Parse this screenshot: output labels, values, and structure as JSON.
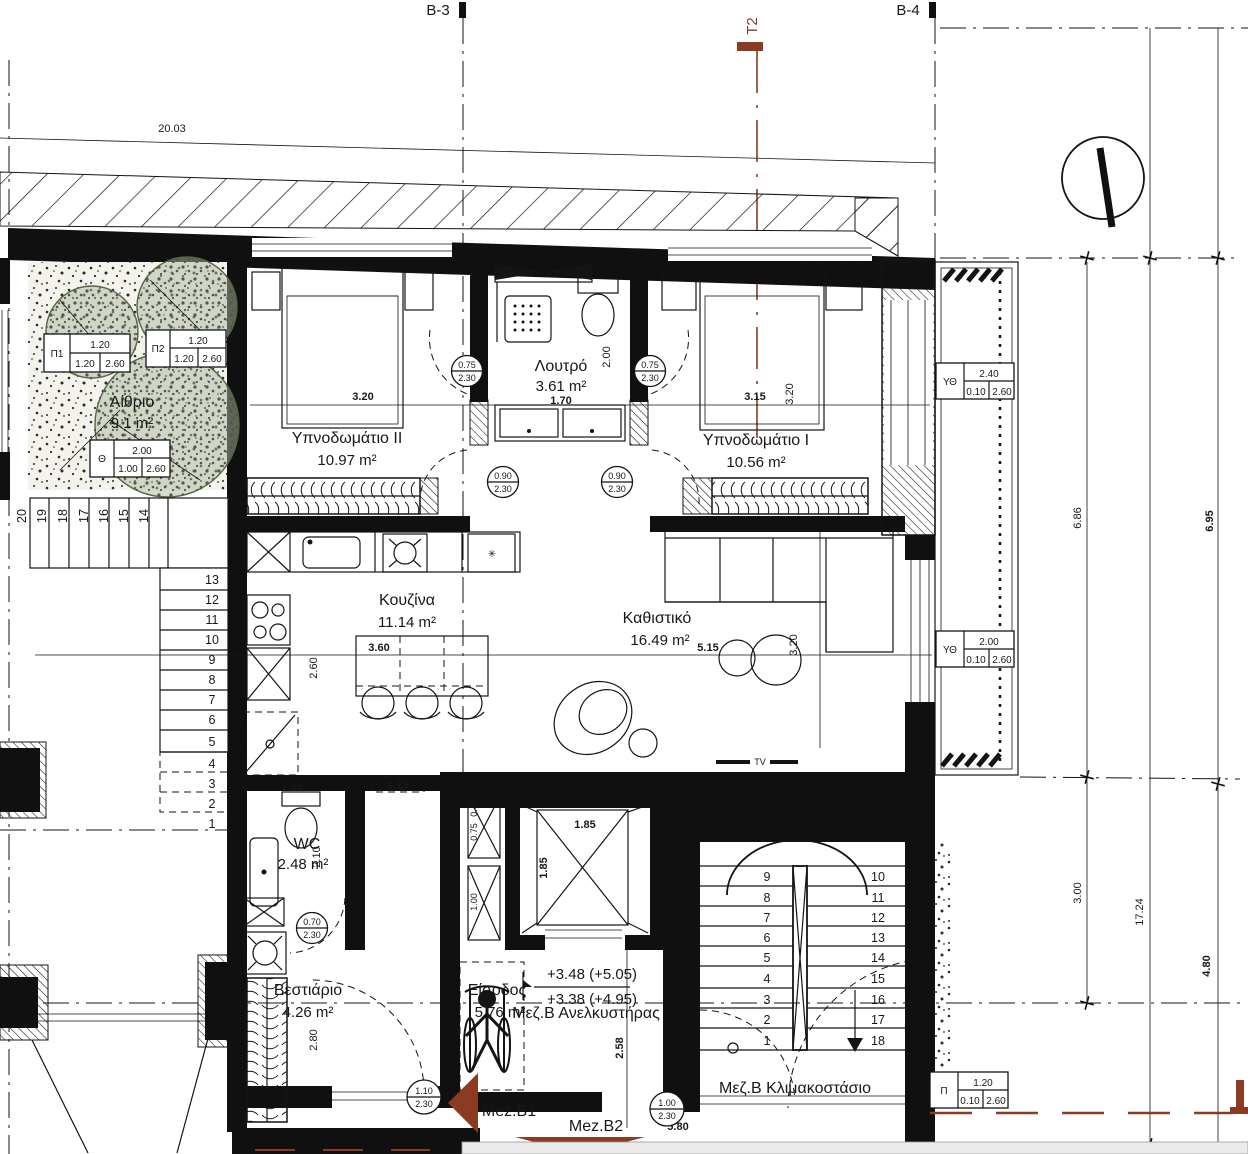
{
  "labels": {
    "b3": "B-3",
    "b4": "B-4",
    "t2": "T2",
    "tv": "TV",
    "bath_name": "Λουτρό",
    "bath_area": "3.61 m²",
    "bed2_name": "Υπνοδωμάτιο II",
    "bed2_area": "10.97 m²",
    "bed1_name": "Υπνοδωμάτιο I",
    "bed1_area": "10.56 m²",
    "kitchen_name": "Κουζίνα",
    "kitchen_area": "11.14 m²",
    "living_name": "Καθιστικό",
    "living_area": "16.49 m²",
    "wc_name": "WC",
    "wc_area": "2.48 m²",
    "cloak_name": "Βεστιάριο",
    "cloak_area": "4.26 m²",
    "entry_name": "Είσοδος",
    "entry_area": "5.76 m²",
    "atrium_name": "Αίθριο",
    "atrium_area": "9.1 m²",
    "lift": "Μεζ.Β Ανελκυστήρας",
    "stairwell": "Μεζ.Β Κλιμακοστάσιο",
    "unit_b1": "Mez.B1",
    "unit_b2": "Mez.B2",
    "level_upper": "+3.48 (+5.05)",
    "level_lower": "+3.38 (+4.95)",
    "star": "✳"
  },
  "dims": {
    "site": "20.03",
    "bed2_w": "3.20",
    "bath_w": "1.70",
    "bath_d": "2.00",
    "bed1_w": "3.15",
    "bed1_d": "3.20",
    "kitchen_w": "3.60",
    "kitchen_d": "2.60",
    "living_w": "5.15",
    "living_d": "3.20",
    "wc_w": "1.35",
    "hall_w": "1.15",
    "wc_d": "2.10",
    "entry_d": "2.80",
    "duct_a": "0.40",
    "duct_b": "0.75",
    "duct_c": "1.00",
    "lift_w": "1.85",
    "lift_d": "1.85",
    "lobby_d": "2.58",
    "stair_w": "5.80",
    "r1": "6.86",
    "r2": "6.95",
    "r3": "3.00",
    "r4": "17.24",
    "r5": "4.80"
  },
  "doors": {
    "d1w": "0.75",
    "d1h": "2.30",
    "d2w": "0.75",
    "d2h": "2.30",
    "d3w": "0.90",
    "d3h": "2.30",
    "d4w": "0.90",
    "d4h": "2.30",
    "d5w": "0.70",
    "d5h": "2.30",
    "d6w": "1.10",
    "d6h": "2.30",
    "d7w": "1.00",
    "d7h": "2.30"
  },
  "schedules": {
    "ut1": {
      "tag": "ΥΘ",
      "w": "2.40",
      "a": "0.10",
      "b": "2.60"
    },
    "ut2": {
      "tag": "ΥΘ",
      "w": "2.00",
      "a": "0.10",
      "b": "2.60"
    },
    "p": {
      "tag": "Π",
      "w": "1.20",
      "a": "0.10",
      "b": "2.60"
    },
    "p1": {
      "tag": "Π1",
      "w": "1.20",
      "a": "1.20",
      "b": "2.60"
    },
    "p2": {
      "tag": "Π2",
      "w": "1.20",
      "a": "1.20",
      "b": "2.60"
    },
    "th": {
      "tag": "Θ",
      "w": "2.00",
      "a": "1.00",
      "b": "2.60"
    }
  },
  "stairs": {
    "outer_top": [
      "20",
      "19",
      "18",
      "17",
      "16",
      "15",
      "14"
    ],
    "outer_side": [
      "13",
      "12",
      "11",
      "10",
      "9",
      "8",
      "7",
      "6",
      "5",
      "4",
      "3",
      "2",
      "1"
    ],
    "main_left": [
      "9",
      "8",
      "7",
      "6",
      "5",
      "4",
      "3",
      "2",
      "1"
    ],
    "main_right": [
      "10",
      "11",
      "12",
      "13",
      "14",
      "15",
      "16",
      "17",
      "18"
    ]
  },
  "colors": {
    "accent": "#8a3b22",
    "line": "#141414",
    "tree": "#6b7d5e"
  }
}
